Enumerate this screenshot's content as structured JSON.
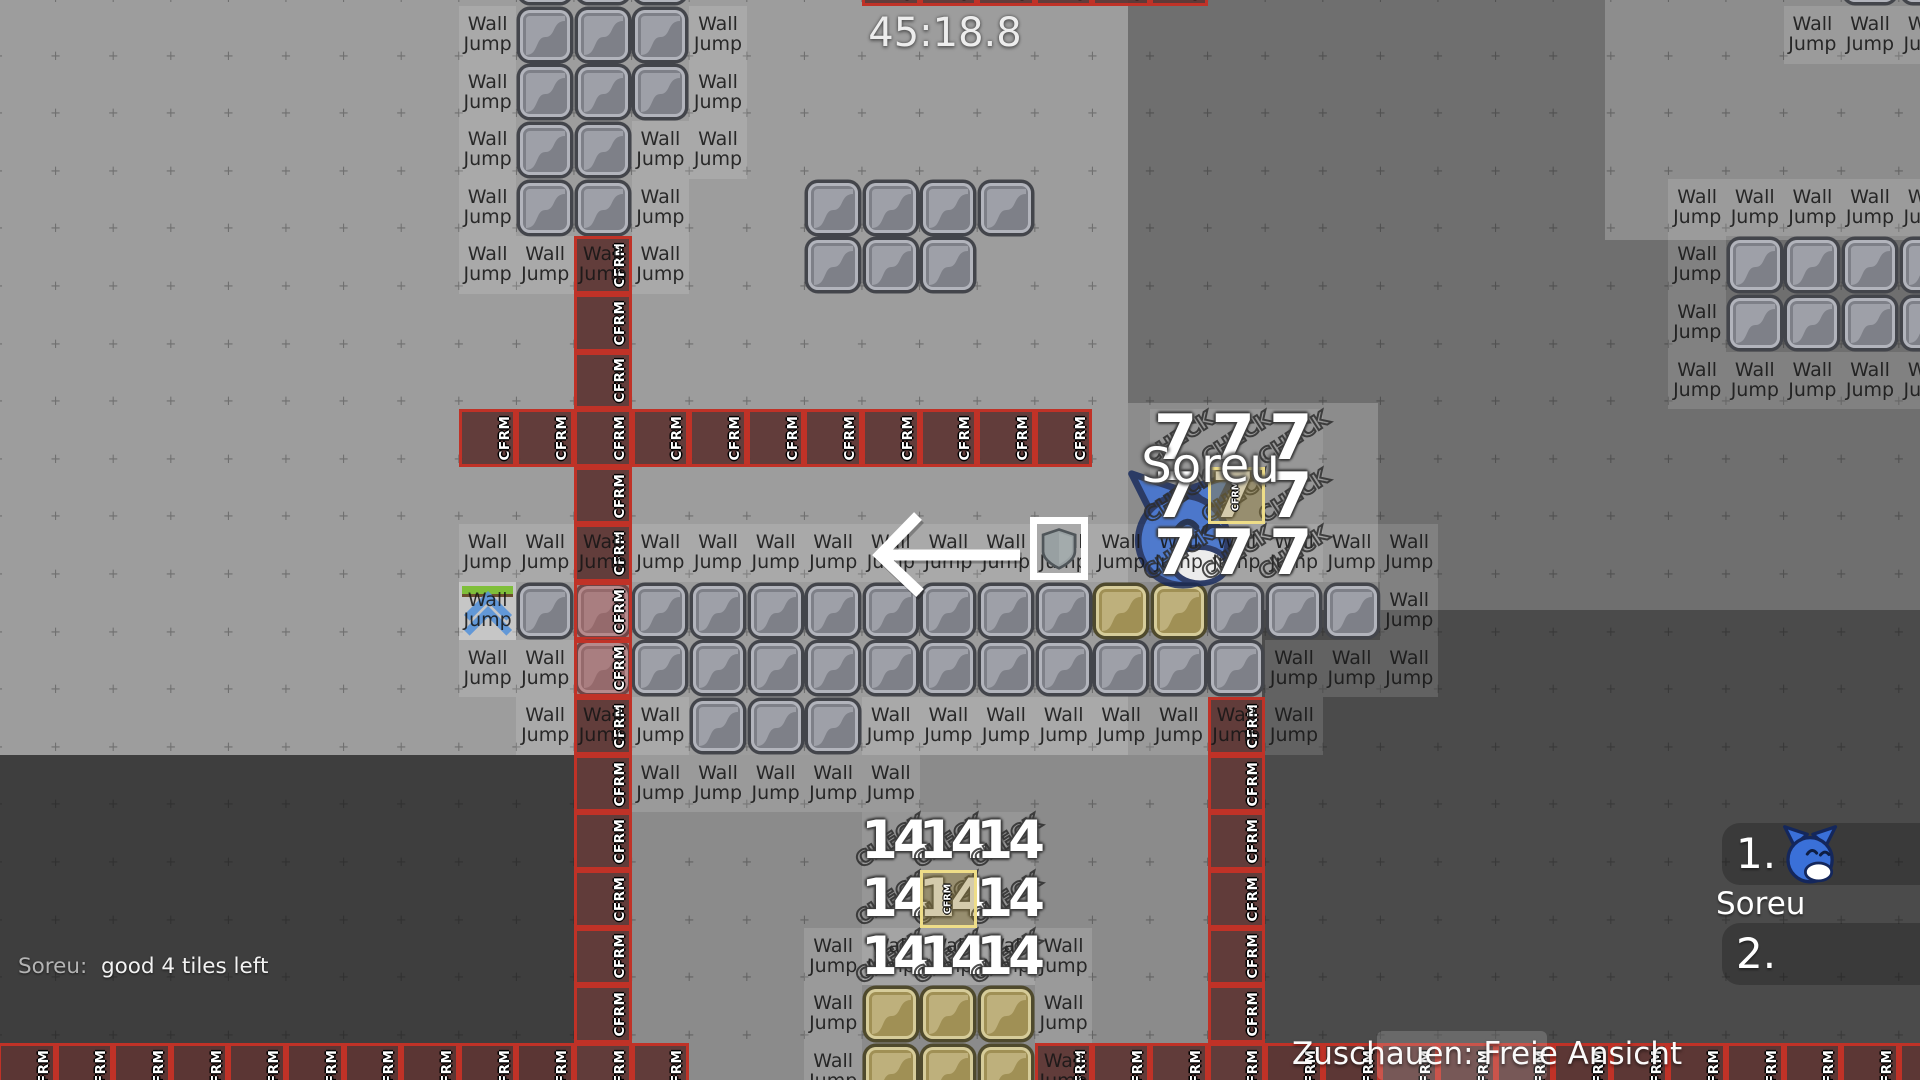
{
  "hud": {
    "timer": "45:18.8",
    "chat": {
      "author": "Soreu:",
      "message": "good 4 tiles left"
    },
    "spectate_label": "Zuschauen: Freie Ansicht",
    "nameplate": "Soreu",
    "scoreboard": {
      "entries": [
        {
          "rank": "1.",
          "name": "Soreu",
          "icon": "blue-cat-tee"
        },
        {
          "rank": "2.",
          "name": ""
        }
      ]
    }
  },
  "labels": {
    "wall_jump_line1": "Wall",
    "wall_jump_line2": "Jump",
    "cfrm": "CFRM",
    "check": "CHECK",
    "switch7": "7",
    "switch14": "14"
  },
  "colors": {
    "base": "#6f6f6f",
    "region_light": "#9d9d9d",
    "region_mid": "#8b8b8b",
    "region_mid2": "#8c8c8c",
    "region_top_right": "#8d8d8d",
    "region_dark_left": "#3e3e3e",
    "region_dark_right": "#4b4b4b",
    "tile_gray_body": "#7e8088",
    "tile_gray_swoosh": "#9ea0a8",
    "tile_gold_body": "#a09055",
    "tile_gold_swoosh": "#beb07c",
    "cfrm_border": "#c03227",
    "select_yellow": "#eedd88",
    "tee_blue": "#3a70d8"
  },
  "map": {
    "tile_size": 57.6,
    "origin": {
      "x": -2,
      "y": 6
    },
    "regions": [
      {
        "x": 0,
        "y": 0,
        "w": 1128,
        "h": 755,
        "color": "region_light"
      },
      {
        "x": 1128,
        "y": 403,
        "w": 250,
        "h": 352,
        "color": "region_mid2"
      },
      {
        "x": 1605,
        "y": 0,
        "w": 315,
        "h": 240,
        "color": "region_top_right"
      },
      {
        "x": 1262,
        "y": 610,
        "w": 658,
        "h": 470,
        "color": "region_dark_right"
      },
      {
        "x": 575,
        "y": 755,
        "w": 687,
        "h": 325,
        "color": "region_mid"
      },
      {
        "x": 0,
        "y": 755,
        "w": 575,
        "h": 325,
        "color": "region_dark_left"
      }
    ],
    "cells": {
      "gray_tiles": [
        [
          9,
          -1
        ],
        [
          10,
          -1
        ],
        [
          11,
          -1
        ],
        [
          32,
          -1
        ],
        [
          33,
          -1
        ],
        [
          9,
          0
        ],
        [
          10,
          0
        ],
        [
          11,
          0
        ],
        [
          9,
          1
        ],
        [
          10,
          1
        ],
        [
          11,
          1
        ],
        [
          9,
          2
        ],
        [
          10,
          2
        ],
        [
          9,
          3
        ],
        [
          10,
          3
        ],
        [
          14,
          3
        ],
        [
          15,
          3
        ],
        [
          16,
          3
        ],
        [
          17,
          3
        ],
        [
          14,
          4
        ],
        [
          15,
          4
        ],
        [
          16,
          4
        ],
        [
          30,
          4
        ],
        [
          31,
          4
        ],
        [
          32,
          4
        ],
        [
          33,
          4
        ],
        [
          30,
          5
        ],
        [
          31,
          5
        ],
        [
          32,
          5
        ],
        [
          33,
          5
        ],
        [
          9,
          10
        ],
        [
          11,
          10
        ],
        [
          12,
          10
        ],
        [
          13,
          10
        ],
        [
          14,
          10
        ],
        [
          15,
          10
        ],
        [
          16,
          10
        ],
        [
          17,
          10
        ],
        [
          18,
          10
        ],
        [
          21,
          10
        ],
        [
          22,
          10
        ],
        [
          23,
          10
        ],
        [
          11,
          11
        ],
        [
          12,
          11
        ],
        [
          13,
          11
        ],
        [
          14,
          11
        ],
        [
          15,
          11
        ],
        [
          16,
          11
        ],
        [
          17,
          11
        ],
        [
          18,
          11
        ],
        [
          19,
          11
        ],
        [
          20,
          11
        ],
        [
          21,
          11
        ],
        [
          12,
          12
        ],
        [
          13,
          12
        ],
        [
          14,
          12
        ]
      ],
      "gold_tiles": [
        [
          19,
          10
        ],
        [
          20,
          10
        ],
        [
          15,
          17
        ],
        [
          16,
          17
        ],
        [
          17,
          17
        ],
        [
          15,
          18
        ],
        [
          16,
          18
        ],
        [
          17,
          18
        ]
      ],
      "red_tiles": [
        [
          10,
          10
        ],
        [
          10,
          11
        ]
      ],
      "wall_jump_labels": [
        [
          8,
          0
        ],
        [
          8,
          1
        ],
        [
          8,
          2
        ],
        [
          8,
          3
        ],
        [
          8,
          4
        ],
        [
          12,
          0
        ],
        [
          12,
          1
        ],
        [
          11,
          2
        ],
        [
          12,
          2
        ],
        [
          11,
          3
        ],
        [
          9,
          4
        ],
        [
          11,
          4
        ],
        [
          8,
          9
        ],
        [
          9,
          9
        ],
        [
          11,
          9
        ],
        [
          12,
          9
        ],
        [
          13,
          9
        ],
        [
          14,
          9
        ],
        [
          15,
          9
        ],
        [
          16,
          9
        ],
        [
          17,
          9
        ],
        [
          18,
          9
        ],
        [
          19,
          9
        ],
        [
          20,
          9
        ],
        [
          21,
          9
        ],
        [
          22,
          9
        ],
        [
          23,
          9
        ],
        [
          24,
          9
        ],
        [
          8,
          10
        ],
        [
          24,
          10
        ],
        [
          8,
          11
        ],
        [
          9,
          11
        ],
        [
          22,
          11
        ],
        [
          23,
          11
        ],
        [
          24,
          11
        ],
        [
          9,
          12
        ],
        [
          11,
          12
        ],
        [
          15,
          12
        ],
        [
          16,
          12
        ],
        [
          17,
          12
        ],
        [
          18,
          12
        ],
        [
          19,
          12
        ],
        [
          20,
          12
        ],
        [
          22,
          12
        ],
        [
          11,
          13
        ],
        [
          12,
          13
        ],
        [
          13,
          13
        ],
        [
          14,
          13
        ],
        [
          15,
          13
        ],
        [
          14,
          16
        ],
        [
          15,
          16
        ],
        [
          16,
          16
        ],
        [
          17,
          16
        ],
        [
          18,
          16
        ],
        [
          14,
          17
        ],
        [
          18,
          17
        ],
        [
          14,
          18
        ],
        [
          31,
          0
        ],
        [
          32,
          0
        ],
        [
          33,
          0
        ],
        [
          29,
          3
        ],
        [
          30,
          3
        ],
        [
          31,
          3
        ],
        [
          32,
          3
        ],
        [
          33,
          3
        ],
        [
          29,
          4
        ],
        [
          29,
          5
        ],
        [
          29,
          6
        ],
        [
          30,
          6
        ],
        [
          31,
          6
        ],
        [
          32,
          6
        ],
        [
          33,
          6
        ]
      ],
      "wall_jump_labels_red": [
        [
          10,
          4
        ],
        [
          10,
          9
        ],
        [
          10,
          12
        ],
        [
          21,
          12
        ],
        [
          18,
          18
        ]
      ],
      "cfrm_cells": [
        [
          15,
          -1
        ],
        [
          16,
          -1
        ],
        [
          17,
          -1
        ],
        [
          18,
          -1
        ],
        [
          19,
          -1
        ],
        [
          20,
          -1
        ],
        [
          10,
          5
        ],
        [
          10,
          6
        ],
        [
          10,
          8
        ],
        [
          8,
          7
        ],
        [
          9,
          7
        ],
        [
          10,
          7
        ],
        [
          11,
          7
        ],
        [
          12,
          7
        ],
        [
          13,
          7
        ],
        [
          14,
          7
        ],
        [
          15,
          7
        ],
        [
          16,
          7
        ],
        [
          17,
          7
        ],
        [
          18,
          7
        ],
        [
          10,
          13
        ],
        [
          10,
          14
        ],
        [
          10,
          15
        ],
        [
          10,
          16
        ],
        [
          10,
          17
        ],
        [
          10,
          18
        ],
        [
          21,
          13
        ],
        [
          21,
          14
        ],
        [
          21,
          15
        ],
        [
          21,
          16
        ],
        [
          21,
          17
        ],
        [
          21,
          18
        ],
        [
          0,
          18
        ],
        [
          1,
          18
        ],
        [
          2,
          18
        ],
        [
          3,
          18
        ],
        [
          4,
          18
        ],
        [
          5,
          18
        ],
        [
          6,
          18
        ],
        [
          7,
          18
        ],
        [
          8,
          18
        ],
        [
          9,
          18
        ],
        [
          11,
          18
        ],
        [
          19,
          18
        ],
        [
          20,
          18
        ],
        [
          22,
          18
        ],
        [
          23,
          18
        ],
        [
          24,
          18
        ],
        [
          25,
          18
        ],
        [
          26,
          18
        ],
        [
          27,
          18
        ],
        [
          28,
          18
        ],
        [
          29,
          18
        ],
        [
          30,
          18
        ],
        [
          31,
          18
        ],
        [
          32,
          18
        ],
        [
          33,
          18
        ]
      ],
      "check7": {
        "number": "7",
        "cells": [
          [
            20,
            7
          ],
          [
            21,
            7
          ],
          [
            22,
            7
          ],
          [
            20,
            8
          ],
          [
            21,
            8
          ],
          [
            22,
            8
          ],
          [
            20,
            9
          ],
          [
            21,
            9
          ],
          [
            22,
            9
          ]
        ],
        "center": [
          21,
          8
        ]
      },
      "check14": {
        "number": "14",
        "cells": [
          [
            15,
            14
          ],
          [
            16,
            14
          ],
          [
            17,
            14
          ],
          [
            15,
            15
          ],
          [
            16,
            15
          ],
          [
            17,
            15
          ],
          [
            15,
            16
          ],
          [
            16,
            16
          ],
          [
            17,
            16
          ]
        ],
        "center": [
          16,
          15
        ]
      },
      "walljump_entity": [
        8,
        10
      ]
    },
    "fx": {
      "arrow": {
        "x": 860,
        "y": 500,
        "w": 180,
        "h": 110
      },
      "shield_box": {
        "x": 1030,
        "y": 517,
        "w": 58,
        "h": 63
      },
      "tee": {
        "x": 1122,
        "y": 468,
        "size": 122
      }
    }
  }
}
